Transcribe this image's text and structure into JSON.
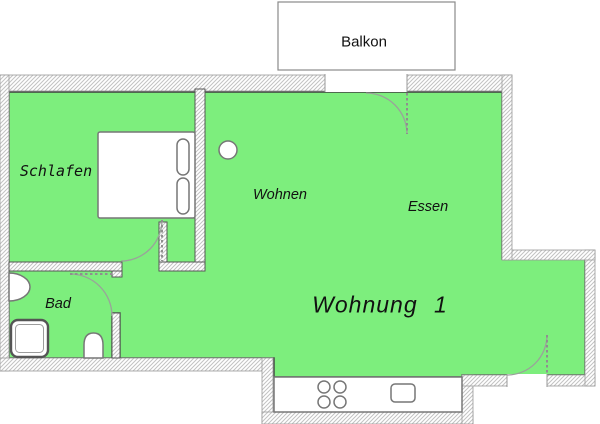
{
  "plan": {
    "apartment_label": "Wohnung 1",
    "rooms": [
      {
        "id": "balkon",
        "label": "Balkon"
      },
      {
        "id": "schlafen",
        "label": "Schlafen"
      },
      {
        "id": "wohnen",
        "label": "Wohnen"
      },
      {
        "id": "essen",
        "label": "Essen"
      },
      {
        "id": "bad",
        "label": "Bad"
      }
    ],
    "colors": {
      "room_fill": "#7dee7d",
      "room_outline": "#3f3f3f",
      "wall_hatch": "#c2c2c2",
      "wall_edge": "#9a9a9a",
      "furniture_outline": "#777777",
      "label_text": "#111111"
    }
  }
}
